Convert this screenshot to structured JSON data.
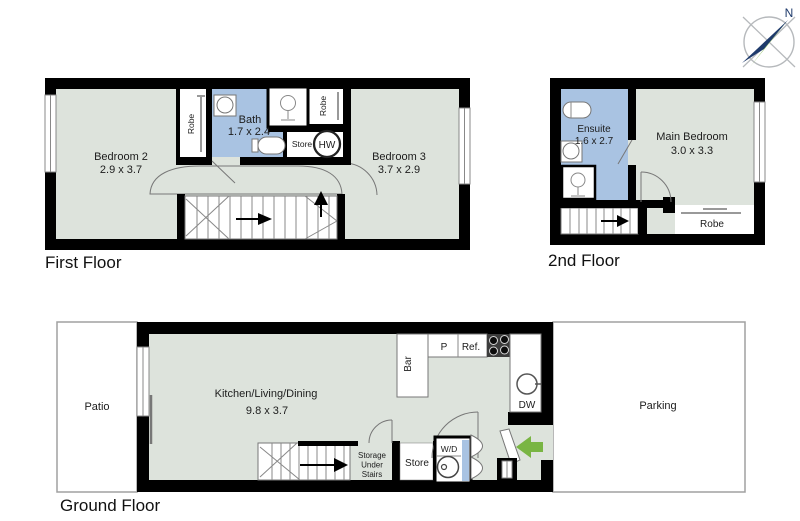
{
  "compass": {
    "north_label": "N"
  },
  "palette": {
    "wall_black": "#000000",
    "room_green": "#dde3dc",
    "wet_area_blue": "#a9c3e2",
    "entry_arrow_green": "#79b543",
    "compass_navy": "#1e3a6b",
    "compass_green": "#76b043",
    "outline_gray": "#999999"
  },
  "floors": {
    "first": {
      "label": "First Floor",
      "bedroom2_name": "Bedroom 2",
      "bedroom2_dims": "2.9 x 3.7",
      "bedroom3_name": "Bedroom 3",
      "bedroom3_dims": "3.7 x 2.9",
      "bath_name": "Bath",
      "bath_dims": "1.7 x 2.4",
      "robe_left": "Robe",
      "robe_right": "Robe",
      "store": "Store",
      "hw": "HW"
    },
    "second": {
      "label": "2nd Floor",
      "ensuite_name": "Ensuite",
      "ensuite_dims": "1.6 x 2.7",
      "main_bedroom_name": "Main Bedroom",
      "main_bedroom_dims": "3.0 x 3.3",
      "robe": "Robe"
    },
    "ground": {
      "label": "Ground Floor",
      "patio": "Patio",
      "parking": "Parking",
      "kitchen_name": "Kitchen/Living/Dining",
      "kitchen_dims": "9.8 x 3.7",
      "bar": "Bar",
      "pantry": "P",
      "fridge": "Ref.",
      "dishwasher": "DW",
      "washer": "W/D",
      "store": "Store",
      "storage_line1": "Storage",
      "storage_line2": "Under",
      "storage_line3": "Stairs"
    }
  }
}
